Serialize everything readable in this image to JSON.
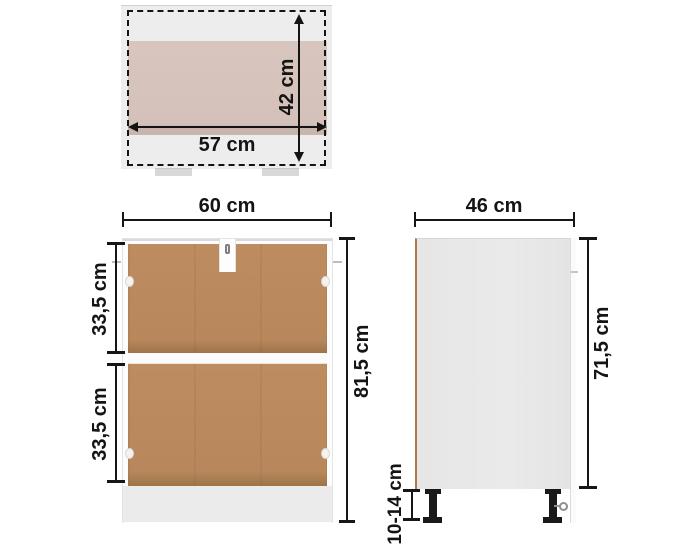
{
  "diagram": {
    "top_view": {
      "width_label": "57 cm",
      "depth_label": "42 cm"
    },
    "front_view": {
      "width_label": "60 cm",
      "height_label": "81,5 cm",
      "upper_compartment_label": "33,5 cm",
      "lower_compartment_label": "33,5 cm"
    },
    "side_view": {
      "depth_label": "46 cm",
      "height_label": "71,5 cm",
      "leg_height_label": "10-14 cm"
    },
    "colors": {
      "hardboard_brown": "#b8875b",
      "worktop_tan": "#d6c4bc",
      "body_gray": "#e9e9e9",
      "plinth_gray": "#ebebeb",
      "line_black": "#141414"
    }
  }
}
